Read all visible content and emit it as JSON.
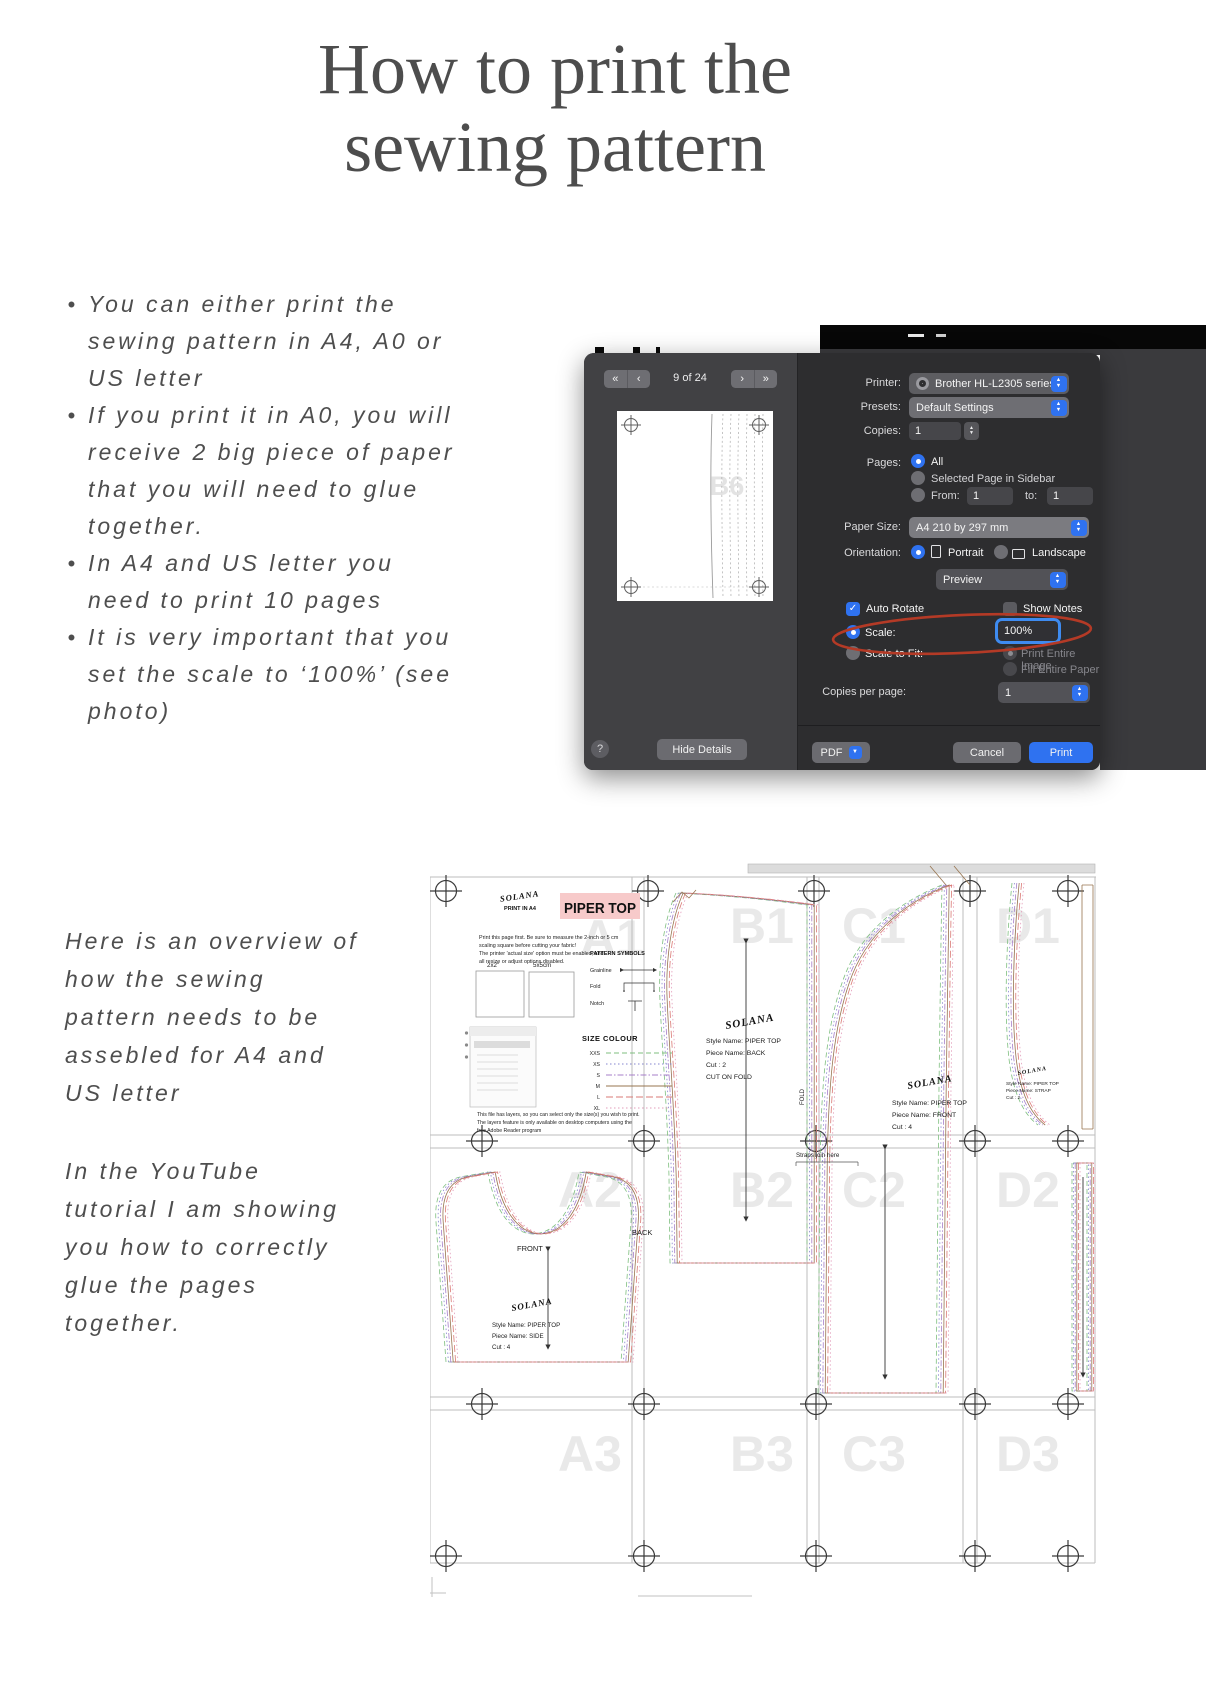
{
  "title": {
    "line1": "How to print the",
    "line2": "sewing pattern"
  },
  "bullets": [
    {
      "lines": [
        "You can either print the",
        "sewing pattern in A4, A0 or",
        "US letter"
      ]
    },
    {
      "lines": [
        "If you print it in A0, you will",
        "receive 2 big piece of paper",
        "that you will need to glue",
        "together."
      ]
    },
    {
      "lines": [
        "In A4 and US letter you",
        "need to print 10 pages"
      ]
    },
    {
      "lines": [
        "It is very important that you",
        "set the scale to ‘100%’ (see",
        "photo)"
      ]
    }
  ],
  "overview_paragraph": {
    "lines": [
      "Here is an overview of",
      "how the sewing",
      "pattern needs to be",
      "assebled for A4 and",
      "US letter"
    ]
  },
  "youtube_paragraph": {
    "lines": [
      "In the YouTube",
      "tutorial I am showing",
      "you how to correctly",
      "glue the pages",
      "together."
    ]
  },
  "icons": {
    "bullet": "•",
    "nav_first": "«",
    "nav_prev": "‹",
    "nav_next": "›",
    "nav_last": "»",
    "caret_up": "▲",
    "caret_down": "▼",
    "check": "✓",
    "help": "?"
  },
  "colors": {
    "accent_blue": "#2f72f0",
    "annotation_red": "#b43a26",
    "banner_pink": "#f7caca"
  },
  "print_dialog": {
    "page_indicator": "9 of 24",
    "preview_watermark": "B6",
    "printer": {
      "label": "Printer:",
      "value": "Brother HL-L2305 series"
    },
    "presets": {
      "label": "Presets:",
      "value": "Default Settings"
    },
    "copies": {
      "label": "Copies:",
      "value": "1"
    },
    "pages": {
      "label": "Pages:",
      "all": "All",
      "selected": "Selected Page in Sidebar",
      "from_label": "From:",
      "from_value": "1",
      "to_label": "to:",
      "to_value": "1"
    },
    "paper_size": {
      "label": "Paper Size:",
      "value": "A4 210 by 297 mm"
    },
    "orientation": {
      "label": "Orientation:",
      "portrait": "Portrait",
      "landscape": "Landscape"
    },
    "section": {
      "value": "Preview"
    },
    "options": {
      "auto_rotate": "Auto Rotate",
      "show_notes": "Show Notes",
      "scale_label": "Scale:",
      "scale_value": "100%",
      "scale_to_fit": "Scale to Fit:",
      "print_entire_image": "Print Entire Image",
      "fill_entire_paper": "Fill Entire Paper",
      "copies_per_page_label": "Copies per page:",
      "copies_per_page_value": "1"
    },
    "buttons": {
      "hide_details": "Hide Details",
      "pdf": "PDF",
      "cancel": "Cancel",
      "print": "Print"
    }
  },
  "pattern": {
    "brand": "SOLANA",
    "print_format": "PRINT IN A4",
    "banner": "PIPER TOP",
    "instructions": [
      "Print this page first. Be sure to measure the 2-inch or 5 cm",
      "scaling square before cutting your fabric!",
      "The printer 'actual size' option must be enabled, and",
      "all resize or adjust options disabled."
    ],
    "test_squares": [
      "2x2\"",
      "5x5cm"
    ],
    "symbols_heading": "PATTERN SYMBOLS",
    "symbols": [
      "Grainline",
      "Fold",
      "Notch"
    ],
    "size_heading": "SIZE COLOUR",
    "size_styles": [
      {
        "size": "XXS",
        "color": "#7fbf7f",
        "dash": "5 3"
      },
      {
        "size": "XS",
        "color": "#8585cf",
        "dash": "1.5 2.5"
      },
      {
        "size": "S",
        "color": "#a77fc9",
        "dash": "6 2 1.5 2"
      },
      {
        "size": "M",
        "color": "#97744f",
        "dash": ""
      },
      {
        "size": "L",
        "color": "#da7a74",
        "dash": "7 3"
      },
      {
        "size": "XL",
        "color": "#e29cba",
        "dash": "1.5 2.5"
      }
    ],
    "layers_note": [
      "This file has layers, so you can select only the size(s) you wish to print.",
      "The layers feature is only available on desktop computers using the",
      "free Adobe Reader program"
    ],
    "tiles": [
      "A1",
      "B1",
      "C1",
      "D1",
      "A2",
      "B2",
      "C2",
      "D2",
      "A3",
      "B3",
      "C3",
      "D3"
    ],
    "pieces": {
      "back": {
        "style": "Style Name: PIPER TOP",
        "piece": "Piece Name: BACK",
        "cut": "Cut : 2",
        "note": "CUT ON FOLD"
      },
      "front": {
        "style": "Style Name: PIPER TOP",
        "piece": "Piece Name: FRONT",
        "cut": "Cut : 4"
      },
      "side": {
        "style": "Style Name: PIPER TOP",
        "piece": "Piece Name: SIDE",
        "cut": "Cut : 4"
      },
      "strap": {
        "style": "Style Name: PIPER TOP",
        "piece": "Piece Name: STRAP",
        "cut": "Cut : 2"
      }
    },
    "labels": {
      "front": "FRONT",
      "back": "BACK",
      "fold": "FOLD",
      "straps_join": "Straps join here"
    }
  }
}
